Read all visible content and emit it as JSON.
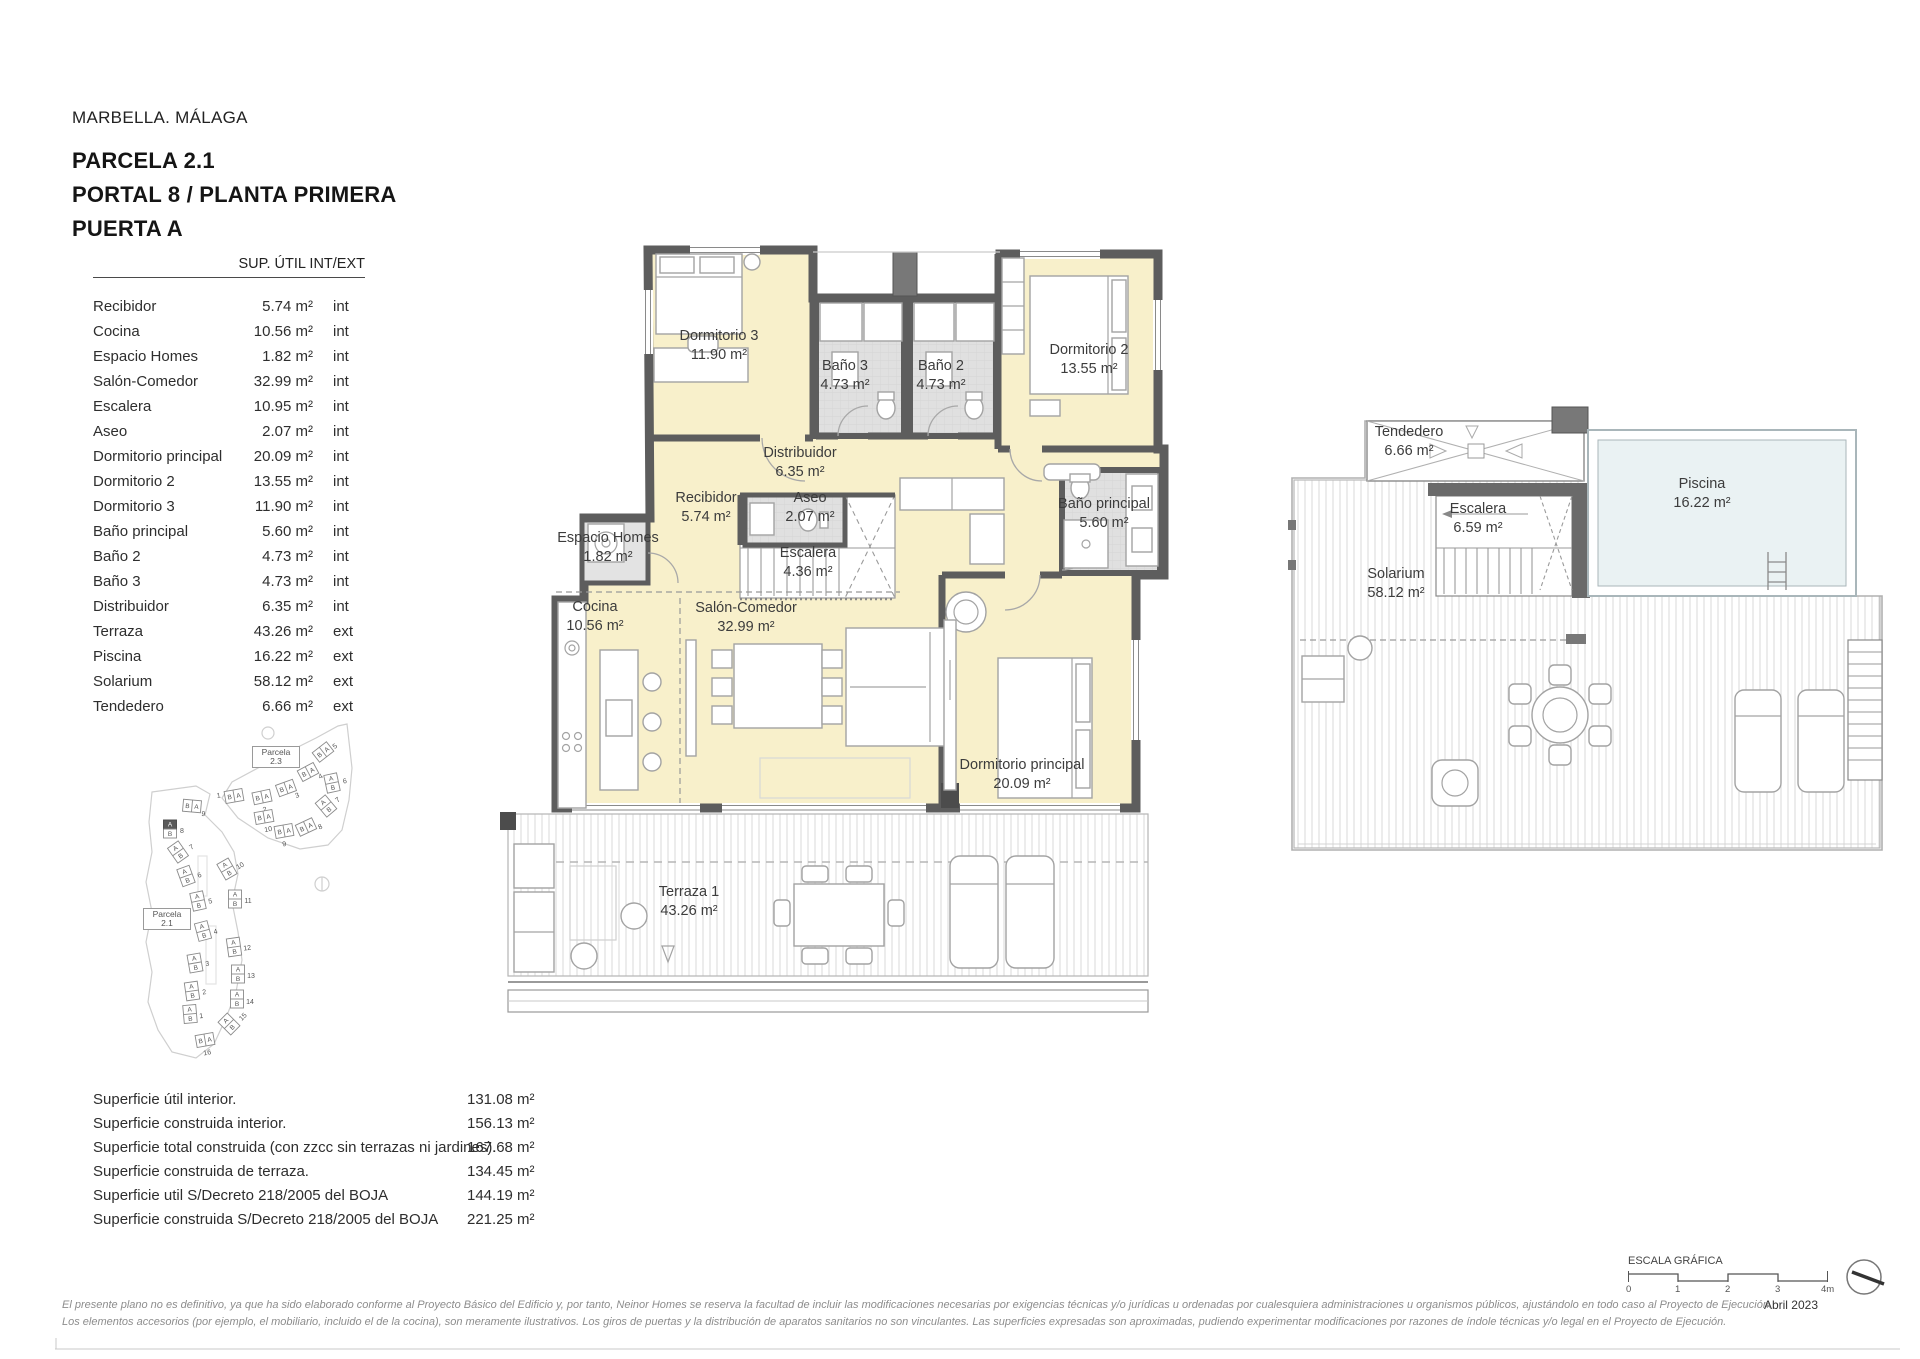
{
  "header": {
    "city": "MARBELLA. MÁLAGA",
    "line1": "PARCELA 2.1",
    "line2": "PORTAL 8 / PLANTA PRIMERA",
    "line3": "PUERTA A"
  },
  "area_table": {
    "header": "SUP. ÚTIL INT/EXT",
    "rows": [
      {
        "name": "Recibidor",
        "area": "5.74 m²",
        "type": "int"
      },
      {
        "name": "Cocina",
        "area": "10.56 m²",
        "type": "int"
      },
      {
        "name": "Espacio Homes",
        "area": "1.82 m²",
        "type": "int"
      },
      {
        "name": "Salón-Comedor",
        "area": "32.99 m²",
        "type": "int"
      },
      {
        "name": "Escalera",
        "area": "10.95 m²",
        "type": "int"
      },
      {
        "name": "Aseo",
        "area": "2.07 m²",
        "type": "int"
      },
      {
        "name": "Dormitorio principal",
        "area": "20.09 m²",
        "type": "int"
      },
      {
        "name": "Dormitorio 2",
        "area": "13.55 m²",
        "type": "int"
      },
      {
        "name": "Dormitorio 3",
        "area": "11.90 m²",
        "type": "int"
      },
      {
        "name": "Baño principal",
        "area": "5.60 m²",
        "type": "int"
      },
      {
        "name": "Baño 2",
        "area": "4.73 m²",
        "type": "int"
      },
      {
        "name": "Baño 3",
        "area": "4.73 m²",
        "type": "int"
      },
      {
        "name": "Distribuidor",
        "area": "6.35 m²",
        "type": "int"
      },
      {
        "name": "Terraza",
        "area": "43.26 m²",
        "type": "ext"
      },
      {
        "name": "Piscina",
        "area": "16.22 m²",
        "type": "ext"
      },
      {
        "name": "Solarium",
        "area": "58.12 m²",
        "type": "ext"
      },
      {
        "name": "Tendedero",
        "area": "6.66 m²",
        "type": "ext"
      }
    ]
  },
  "site_plan": {
    "parcela_23_line1": "Parcela",
    "parcela_23_line2": "2.3",
    "parcela_21_line1": "Parcela",
    "parcela_21_line2": "2.1",
    "letter_a": "A",
    "letter_b": "B",
    "highlighted_block": "8",
    "p23_nums": [
      "1",
      "2",
      "3",
      "4",
      "5",
      "6",
      "7",
      "8",
      "9",
      "10"
    ],
    "p21_nums": [
      "1",
      "2",
      "3",
      "4",
      "5",
      "6",
      "7",
      "8",
      "9",
      "10",
      "11",
      "12",
      "13",
      "14",
      "15",
      "16"
    ]
  },
  "floor_plan": {
    "rooms": {
      "dormitorio3": {
        "name": "Dormitorio 3",
        "area": "11.90 m²"
      },
      "bano3": {
        "name": "Baño 3",
        "area": "4.73 m²"
      },
      "bano2": {
        "name": "Baño 2",
        "area": "4.73 m²"
      },
      "dormitorio2": {
        "name": "Dormitorio 2",
        "area": "13.55 m²"
      },
      "distribuidor": {
        "name": "Distribuidor",
        "area": "6.35 m²"
      },
      "recibidor": {
        "name": "Recibidor",
        "area": "5.74 m²"
      },
      "aseo": {
        "name": "Aseo",
        "area": "2.07 m²"
      },
      "escalera": {
        "name": "Escalera",
        "area": "4.36 m²"
      },
      "espacio_homes": {
        "name": "Espacio Homes",
        "area": "1.82 m²"
      },
      "bano_principal": {
        "name": "Baño principal",
        "area": "5.60 m²"
      },
      "cocina": {
        "name": "Cocina",
        "area": "10.56 m²"
      },
      "salon": {
        "name": "Salón-Comedor",
        "area": "32.99 m²"
      },
      "dormitorio_principal": {
        "name": "Dormitorio principal",
        "area": "20.09 m²"
      },
      "terraza": {
        "name": "Terraza 1",
        "area": "43.26 m²"
      }
    }
  },
  "upper_plan": {
    "rooms": {
      "tendedero": {
        "name": "Tendedero",
        "area": "6.66 m²"
      },
      "escalera": {
        "name": "Escalera",
        "area": "6.59 m²"
      },
      "piscina": {
        "name": "Piscina",
        "area": "16.22 m²"
      },
      "solarium": {
        "name": "Solarium",
        "area": "58.12 m²"
      }
    }
  },
  "summary": {
    "rows": [
      {
        "label": "Superficie útil interior.",
        "value": "131.08 m²"
      },
      {
        "label": "Superficie construida interior.",
        "value": "156.13 m²"
      },
      {
        "label": "Superficie total construida (con zzcc sin terrazas ni jardines).",
        "value": "167.68 m²"
      },
      {
        "label": "Superficie construida de terraza.",
        "value": "134.45 m²"
      },
      {
        "label": "Superficie util S/Decreto 218/2005 del BOJA",
        "value": "144.19 m²"
      },
      {
        "label": "Superficie construida S/Decreto 218/2005 del BOJA",
        "value": "221.25 m²"
      }
    ]
  },
  "scale_bar": {
    "title": "ESCALA GRÁFICA",
    "ticks": [
      "0",
      "1",
      "2",
      "3",
      "4m"
    ],
    "date": "Abril 2023"
  },
  "footer": {
    "line1": "El presente plano no es definitivo, ya que ha sido elaborado conforme al Proyecto Básico del Edificio y, por tanto, Neinor Homes se reserva la facultad de incluir las modificaciones necesarias por exigencias técnicas y/o jurídicas u ordenadas por cualesquiera administraciones u organismos públicos, ajustándolo en todo caso al Proyecto de Ejecución.",
    "line2": "Los elementos accesorios (por ejemplo, el mobiliario, incluido el de la cocina), son meramente ilustrativos. Los giros de puertas y la distribución de aparatos sanitarios no son vinculantes. Las superficies expresadas son aproximadas, pudiendo experimentar modificaciones por razones de índole técnicas y/o legal en el Proyecto de Ejecución."
  },
  "colors": {
    "room_fill": "#f8f0cb",
    "wet_room_fill": "#e0e0e0",
    "wall": "#5d5d5d",
    "pool_fill": "#eaf2f3",
    "deck_line": "#d9d9d9"
  }
}
